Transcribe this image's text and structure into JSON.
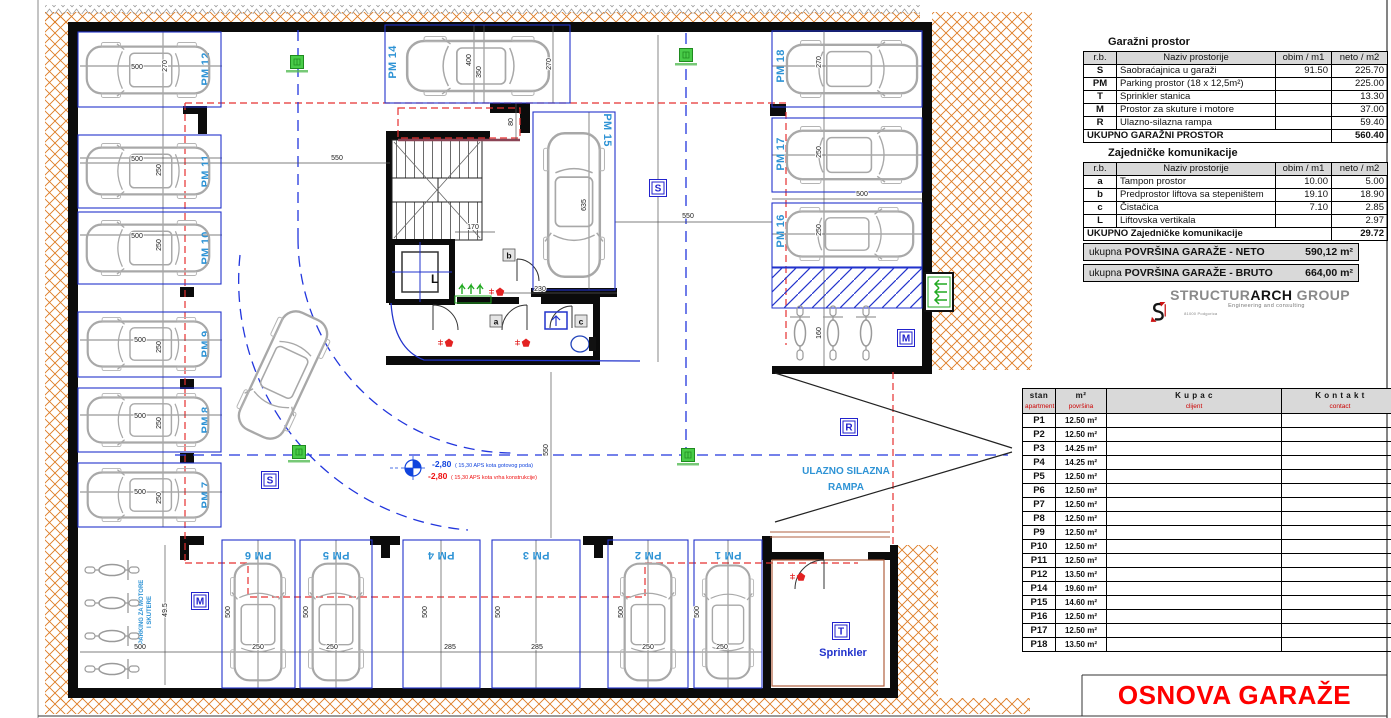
{
  "page": {
    "title": "OSNOVA GARAŽE"
  },
  "logo": {
    "brand_prefix": "STRUCTUR",
    "brand_core": "ARCH",
    "brand_suffix": " GROUP",
    "tagline": "Engineering and consulting",
    "address": "81000 Podgorica"
  },
  "garage_table": {
    "title": "Garažni prostor",
    "headers": [
      "r.b.",
      "Naziv prostorije",
      "obim / m1",
      "neto / m2"
    ],
    "rows": [
      [
        "S",
        "Saobraćajnica u garaži",
        "91.50",
        "225.70"
      ],
      [
        "PM",
        "Parking prostor  (18 x 12,5m²)",
        "",
        "225.00"
      ],
      [
        "T",
        "Sprinkler stanica",
        "",
        "13.30"
      ],
      [
        "M",
        "Prostor za skuture i motore",
        "",
        "37.00"
      ],
      [
        "R",
        "Ulazno-silazna rampa",
        "",
        "59.40"
      ]
    ],
    "total_label": "UKUPNO GARAŽNI PROSTOR",
    "total_value": "560.40"
  },
  "common_table": {
    "title": "Zajedničke komunikacije",
    "headers": [
      "r.b.",
      "Naziv prostorije",
      "obim / m1",
      "neto / m2"
    ],
    "rows": [
      [
        "a",
        "Tampon prostor",
        "10.00",
        "5.00"
      ],
      [
        "b",
        "Predprostor liftova sa stepeništem",
        "19.10",
        "18.90"
      ],
      [
        "c",
        "Čistačica",
        "7.10",
        "2.85"
      ],
      [
        "L",
        "Liftovska vertikala",
        "",
        "2.97"
      ]
    ],
    "total_label": "UKUPNO Zajedničke komunikacije",
    "total_value": "29.72"
  },
  "summary": [
    {
      "label_prefix": "ukupna ",
      "label_bold": "POVRŠINA GARAŽE - NETO",
      "value": "590,12 m²"
    },
    {
      "label_prefix": "ukupna ",
      "label_bold": "POVRŠINA GARAŽE - BRUTO",
      "value": "664,00 m²"
    }
  ],
  "apartments": {
    "headers": {
      "col1": "stan",
      "col1_sub": "apartment",
      "col2": "m²",
      "col2_sub": "površina",
      "col3": "K u p a c",
      "col3_sub": "clijent",
      "col4": "K o n t a k t",
      "col4_sub": "contact"
    },
    "rows": [
      {
        "id": "P1",
        "area": "12.50 m²"
      },
      {
        "id": "P2",
        "area": "12.50 m²"
      },
      {
        "id": "P3",
        "area": "14.25 m²"
      },
      {
        "id": "P4",
        "area": "14.25 m²"
      },
      {
        "id": "P5",
        "area": "12.50 m²"
      },
      {
        "id": "P6",
        "area": "12.50 m²"
      },
      {
        "id": "P7",
        "area": "12.50 m²"
      },
      {
        "id": "P8",
        "area": "12.50 m²"
      },
      {
        "id": "P9",
        "area": "12.50 m²"
      },
      {
        "id": "P10",
        "area": "12.50 m²"
      },
      {
        "id": "P11",
        "area": "12.50 m²"
      },
      {
        "id": "P12",
        "area": "13.50 m²"
      },
      {
        "id": "P14",
        "area": "19.60 m²"
      },
      {
        "id": "P15",
        "area": "14.60 m²"
      },
      {
        "id": "P16",
        "area": "12.50 m²"
      },
      {
        "id": "P17",
        "area": "12.50 m²"
      },
      {
        "id": "P18",
        "area": "13.50 m²"
      }
    ]
  },
  "plan": {
    "texts": {
      "ramp_line1": "ULAZNO SILAZNA",
      "ramp_line2": "RAMPA",
      "sprinkler": "Sprinkler",
      "moto_line1": "PARKING ZA MOTORE",
      "moto_line2": "I SKUTERE"
    },
    "level": {
      "value_floor": "-2,80",
      "note_floor": "( 15,30 APS kota gotovog poda)",
      "value_structure": "-2,80",
      "note_structure": "( 15,30 APS kota vrha konstrukcije)"
    },
    "stalls": [
      {
        "label": "PM 12",
        "x": 78,
        "y": 32,
        "w": 143,
        "h": 75,
        "lx": 209,
        "ly": 69,
        "lr": -90,
        "car": [
          148,
          70,
          128,
          56,
          180
        ]
      },
      {
        "label": "PM 11",
        "x": 78,
        "y": 135,
        "w": 143,
        "h": 73,
        "lx": 209,
        "ly": 171,
        "lr": -90,
        "car": [
          148,
          171,
          128,
          56,
          180
        ]
      },
      {
        "label": "PM 10",
        "x": 78,
        "y": 212,
        "w": 143,
        "h": 72,
        "lx": 209,
        "ly": 248,
        "lr": -90,
        "car": [
          148,
          248,
          128,
          56,
          180
        ]
      },
      {
        "label": "PM 9",
        "x": 78,
        "y": 312,
        "w": 143,
        "h": 65,
        "lx": 209,
        "ly": 344,
        "lr": -90,
        "car": [
          148,
          344,
          126,
          54,
          180
        ]
      },
      {
        "label": "PM 8",
        "x": 78,
        "y": 388,
        "w": 143,
        "h": 64,
        "lx": 209,
        "ly": 420,
        "lr": -90,
        "car": [
          148,
          420,
          126,
          54,
          180
        ]
      },
      {
        "label": "PM 7",
        "x": 78,
        "y": 463,
        "w": 143,
        "h": 64,
        "lx": 209,
        "ly": 495,
        "lr": -90,
        "car": [
          148,
          495,
          126,
          54,
          180
        ]
      },
      {
        "label": "PM 6",
        "x": 222,
        "y": 540,
        "w": 73,
        "h": 148,
        "lx": 258,
        "ly": 552,
        "lr": 180,
        "car": [
          258,
          622,
          122,
          56,
          -90
        ]
      },
      {
        "label": "PM 5",
        "x": 300,
        "y": 540,
        "w": 72,
        "h": 148,
        "lx": 336,
        "ly": 552,
        "lr": 180,
        "car": [
          336,
          622,
          122,
          56,
          -90
        ]
      },
      {
        "label": "PM 4",
        "x": 403,
        "y": 540,
        "w": 77,
        "h": 148,
        "lx": 441,
        "ly": 552,
        "lr": 180,
        "car": null
      },
      {
        "label": "PM 3",
        "x": 492,
        "y": 540,
        "w": 88,
        "h": 148,
        "lx": 536,
        "ly": 552,
        "lr": 180,
        "car": null
      },
      {
        "label": "PM 2",
        "x": 608,
        "y": 540,
        "w": 80,
        "h": 148,
        "lx": 648,
        "ly": 552,
        "lr": 180,
        "car": [
          648,
          622,
          122,
          56,
          -90
        ]
      },
      {
        "label": "PM 1",
        "x": 694,
        "y": 540,
        "w": 68,
        "h": 148,
        "lx": 728,
        "ly": 552,
        "lr": 180,
        "car": [
          728,
          622,
          118,
          52,
          -90
        ]
      },
      {
        "label": "PM 14",
        "x": 385,
        "y": 25,
        "w": 185,
        "h": 78,
        "lx": 396,
        "ly": 62,
        "lr": -90,
        "car": [
          478,
          66,
          148,
          60,
          180
        ]
      },
      {
        "label": "PM 15",
        "x": 533,
        "y": 112,
        "w": 82,
        "h": 178,
        "lx": 604,
        "ly": 130,
        "lr": 90,
        "car": [
          574,
          205,
          150,
          62,
          90
        ]
      },
      {
        "label": "PM 18",
        "x": 772,
        "y": 31,
        "w": 150,
        "h": 76,
        "lx": 784,
        "ly": 66,
        "lr": -90,
        "car": [
          852,
          69,
          136,
          58,
          0
        ]
      },
      {
        "label": "PM 17",
        "x": 772,
        "y": 118,
        "w": 150,
        "h": 74,
        "lx": 784,
        "ly": 154,
        "lr": -90,
        "car": [
          852,
          155,
          136,
          58,
          0
        ]
      },
      {
        "label": "PM 16",
        "x": 772,
        "y": 203,
        "w": 150,
        "h": 64,
        "lx": 784,
        "ly": 231,
        "lr": -90,
        "car": [
          850,
          234,
          132,
          54,
          0
        ]
      }
    ],
    "extra_cars": [
      [
        283,
        375,
        135,
        58,
        115
      ]
    ],
    "motos": [
      [
        112,
        570,
        180
      ],
      [
        112,
        603,
        180
      ],
      [
        112,
        636,
        180
      ],
      [
        112,
        669,
        180
      ],
      [
        800,
        333,
        90
      ],
      [
        833,
        333,
        90
      ],
      [
        866,
        333,
        90
      ]
    ],
    "dims": [
      [
        "500",
        137,
        69,
        0
      ],
      [
        "270",
        167,
        66,
        -90
      ],
      [
        "500",
        137,
        161,
        0
      ],
      [
        "250",
        161,
        170,
        -90
      ],
      [
        "500",
        137,
        238,
        0
      ],
      [
        "250",
        161,
        245,
        -90
      ],
      [
        "500",
        140,
        342,
        0
      ],
      [
        "250",
        161,
        347,
        -90
      ],
      [
        "500",
        140,
        418,
        0
      ],
      [
        "250",
        161,
        423,
        -90
      ],
      [
        "500",
        140,
        494,
        0
      ],
      [
        "250",
        161,
        498,
        -90
      ],
      [
        "550",
        337,
        160,
        0
      ],
      [
        "400",
        471,
        60,
        -90
      ],
      [
        "350",
        481,
        72,
        -90
      ],
      [
        "270",
        551,
        64,
        -90
      ],
      [
        "80",
        513,
        122,
        -90
      ],
      [
        "270",
        821,
        62,
        -90
      ],
      [
        "250",
        821,
        152,
        -90
      ],
      [
        "250",
        821,
        230,
        -90
      ],
      [
        "500",
        862,
        196,
        0
      ],
      [
        "160",
        821,
        333,
        -90
      ],
      [
        "550",
        688,
        218,
        0
      ],
      [
        "550",
        548,
        450,
        -90
      ],
      [
        "170",
        473,
        229,
        0
      ],
      [
        "635",
        586,
        205,
        -90
      ],
      [
        "230",
        540,
        291,
        0
      ],
      [
        "500",
        230,
        612,
        -90
      ],
      [
        "500",
        308,
        612,
        -90
      ],
      [
        "500",
        427,
        612,
        -90
      ],
      [
        "500",
        500,
        612,
        -90
      ],
      [
        "500",
        623,
        612,
        -90
      ],
      [
        "500",
        699,
        612,
        -90
      ],
      [
        "250",
        258,
        649,
        0
      ],
      [
        "250",
        332,
        649,
        0
      ],
      [
        "285",
        450,
        649,
        0
      ],
      [
        "285",
        537,
        649,
        0
      ],
      [
        "250",
        648,
        649,
        0
      ],
      [
        "250",
        722,
        649,
        0
      ],
      [
        "500",
        140,
        649,
        0
      ],
      [
        "49.5",
        167,
        610,
        -90
      ]
    ],
    "tags": [
      [
        "S",
        658,
        188
      ],
      [
        "S",
        270,
        480
      ],
      [
        "M",
        200,
        601
      ],
      [
        "M",
        906,
        338
      ],
      [
        "R",
        849,
        427
      ],
      [
        "T",
        841,
        631
      ]
    ],
    "room_tags": [
      [
        "a",
        496,
        322
      ],
      [
        "b",
        509,
        256
      ],
      [
        "c",
        581,
        322
      ]
    ],
    "lift_label": "L",
    "greens": [
      [
        297,
        62
      ],
      [
        686,
        55
      ],
      [
        688,
        455
      ],
      [
        299,
        452
      ]
    ],
    "reds": [
      [
        500,
        292
      ],
      [
        449,
        343
      ],
      [
        526,
        343
      ],
      [
        801,
        577
      ]
    ]
  }
}
